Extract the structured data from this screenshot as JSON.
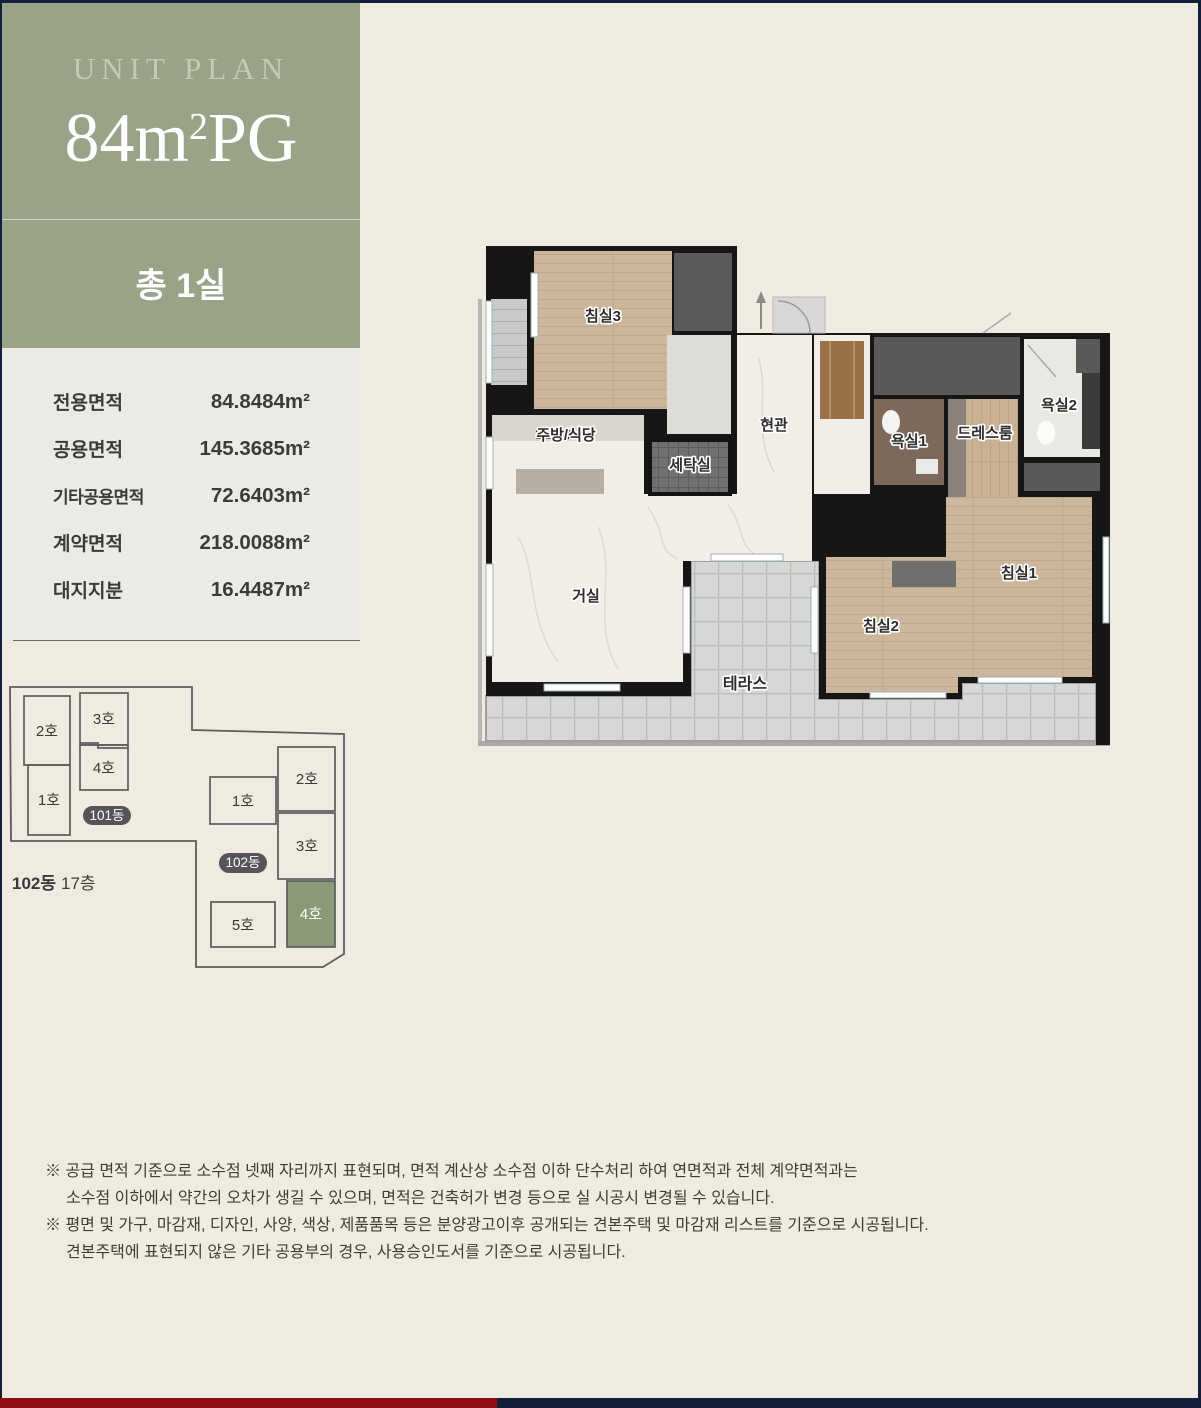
{
  "page": {
    "background": "#F0EBE1",
    "frame_color": "#132039",
    "bottom_bar_left_color": "#8F0E12",
    "bottom_bar_right_color": "#132039"
  },
  "header": {
    "panel_color": "#98A388",
    "eyebrow": "UNIT PLAN",
    "unit_size_main": "84m",
    "unit_size_sup": "2",
    "unit_size_tail": "PG",
    "room_count": "총 1실"
  },
  "area_table": {
    "rows": [
      {
        "label": "전용면적",
        "value": "84.8484m²"
      },
      {
        "label": "공용면적",
        "value": "145.3685m²"
      },
      {
        "label": "기타공용면적",
        "value": "72.6403m²"
      },
      {
        "label": "계약면적",
        "value": "218.0088m²"
      },
      {
        "label": "대지지분",
        "value": "16.4487m²"
      }
    ]
  },
  "floorplan": {
    "rooms": [
      {
        "label": "침실3"
      },
      {
        "label": "주방/식당"
      },
      {
        "label": "세탁실"
      },
      {
        "label": "현관"
      },
      {
        "label": "욕실1"
      },
      {
        "label": "드레스룸"
      },
      {
        "label": "욕실2"
      },
      {
        "label": "침실1"
      },
      {
        "label": "침실2"
      },
      {
        "label": "거실"
      },
      {
        "label": "테라스"
      }
    ]
  },
  "siteplan": {
    "caption_building": "102동",
    "caption_floor": "17층",
    "building101": {
      "tag": "101동",
      "units": [
        "2호",
        "1호",
        "3호",
        "4호"
      ]
    },
    "building102": {
      "tag": "102동",
      "units": [
        "1호",
        "2호",
        "3호",
        "5호"
      ]
    },
    "highlight": {
      "unit": "4호",
      "color": "#8A9A76"
    }
  },
  "notes": {
    "lines": [
      "※ 공급 면적 기준으로 소수점 넷째 자리까지 표현되며, 면적 계산상 소수점 이하 단수처리 하여 연면적과 전체 계약면적과는",
      "소수점 이하에서 약간의 오차가 생길 수 있으며, 면적은 건축허가 변경 등으로 실 시공시 변경될 수 있습니다.",
      "※ 평면 및 가구, 마감재, 디자인, 사양, 색상, 제품품목 등은 분양광고이후 공개되는 견본주택 및 마감재 리스트를 기준으로 시공됩니다.",
      "견본주택에 표현되지 않은 기타 공용부의 경우, 사용승인도서를 기준으로 시공됩니다."
    ]
  }
}
